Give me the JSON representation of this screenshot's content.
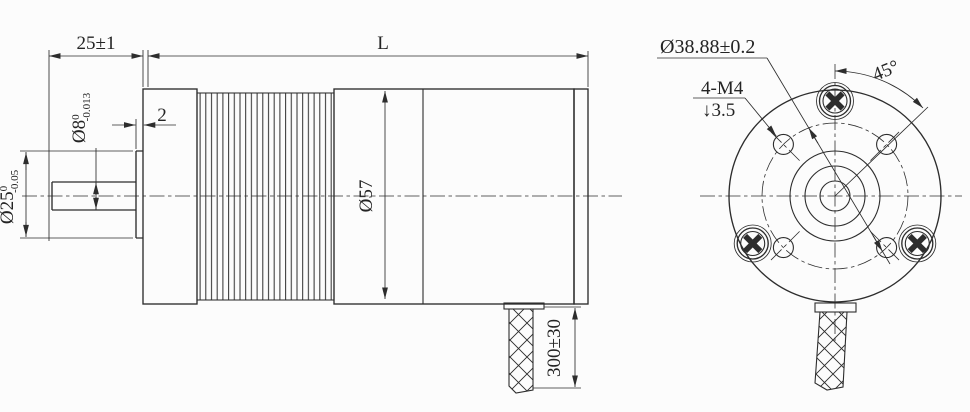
{
  "drawing": {
    "side_view": {
      "shaft_length": "25±1",
      "body_length": "L",
      "boss_thickness": "2",
      "shaft_diameter": {
        "value": "Ø8",
        "tol_upper": "0",
        "tol_lower": "-0.013"
      },
      "boss_diameter": {
        "value": "Ø25",
        "tol_upper": "0",
        "tol_lower": "-0.05"
      },
      "body_diameter": "Ø57",
      "cable_length": "300±30"
    },
    "rear_view": {
      "bolt_circle_diameter": "Ø38.88±0.2",
      "mounting_holes": "4-M4",
      "thread_depth": "↓3.5",
      "hole_angle": "45°"
    },
    "colors": {
      "line": "#2d2d2d",
      "background": "#fcfcfc"
    }
  }
}
